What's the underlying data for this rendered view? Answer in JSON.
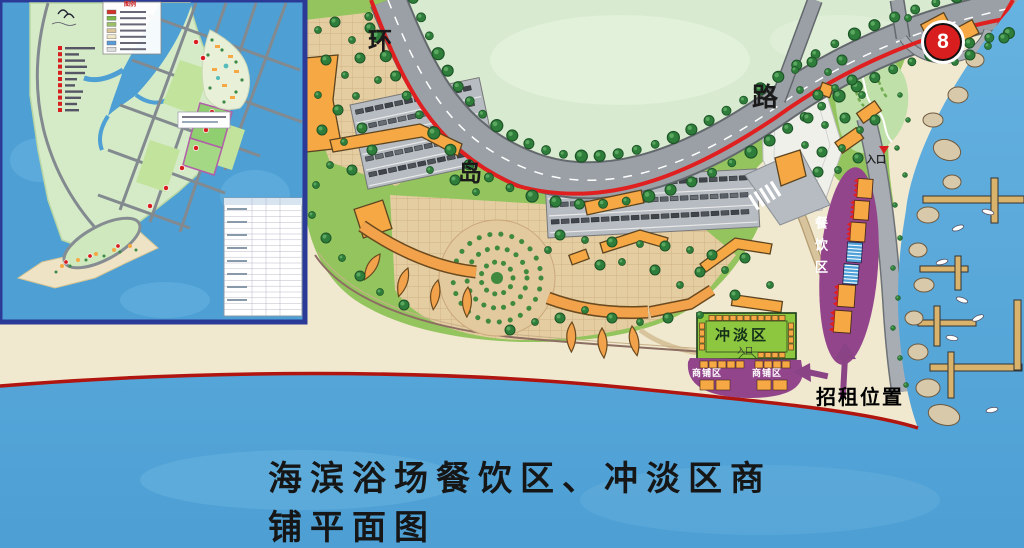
{
  "title": "海滨浴场餐饮区、冲淡区商铺平面图",
  "ring_road": {
    "char_1": "环",
    "char_2": "岛",
    "char_3": "路"
  },
  "route_badge": {
    "number": "8"
  },
  "beach_entrance": {
    "label": "入口"
  },
  "dining_zone": {
    "label": "餐饮区"
  },
  "rinse_zone": {
    "label": "冲淡区",
    "entrance_label": "入口"
  },
  "shop_zone": {
    "left_label": "商铺区",
    "right_label": "商铺区"
  },
  "rental_annotation": {
    "label": "招租位置"
  },
  "inset_map": {
    "legend_title": "图例",
    "legend_swatch_colors": [
      "#d23328",
      "#7ab648",
      "#9cc06a",
      "#d9c49a",
      "#efe6c8",
      "#5b9bd5",
      "#dcdcdc"
    ]
  },
  "colors": {
    "boundary_red": "#e02020",
    "zone_purple": "#93458c",
    "stall_orange": "#f5a843",
    "rinse_green": "#8dc63f",
    "sea_blue": "#55a8d9",
    "sand": "#f0e9cf"
  }
}
